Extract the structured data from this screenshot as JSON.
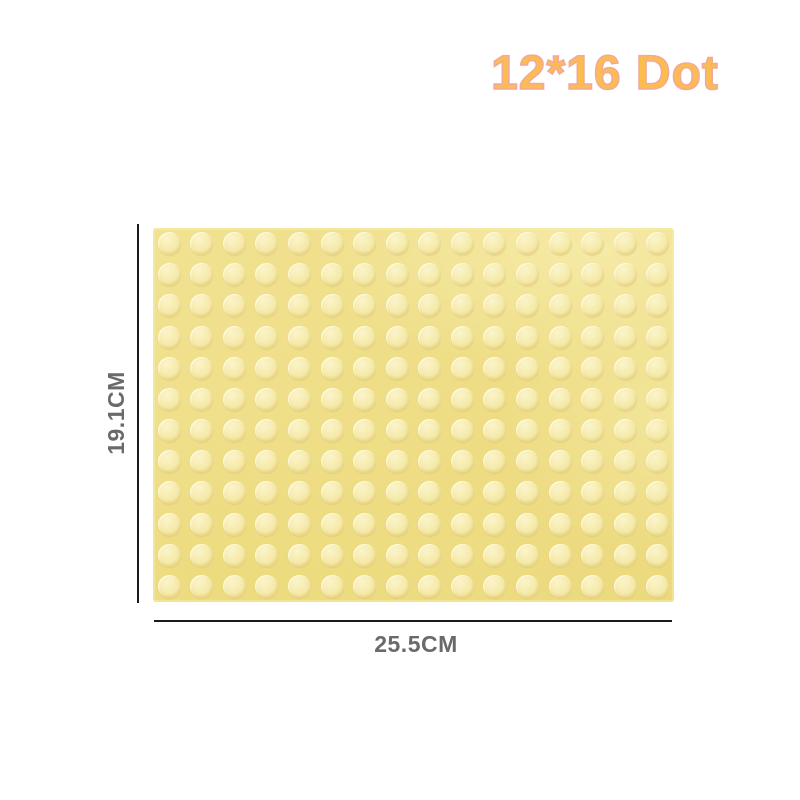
{
  "title": {
    "text": "12*16 Dot"
  },
  "baseplate": {
    "rows": 12,
    "columns": 16,
    "stud_total": 192,
    "base_color": "#EEDD85",
    "stud_color": "#F5EBAB"
  },
  "dimensions": {
    "height_label": "19.1CM",
    "width_label": "25.5CM"
  },
  "colors": {
    "background": "#FFFFFF",
    "title_fill": "#FBBD4D",
    "title_outline": "#F3A89C",
    "label_text": "#6A6A6A",
    "dimension_line": "#1A1A1A"
  }
}
